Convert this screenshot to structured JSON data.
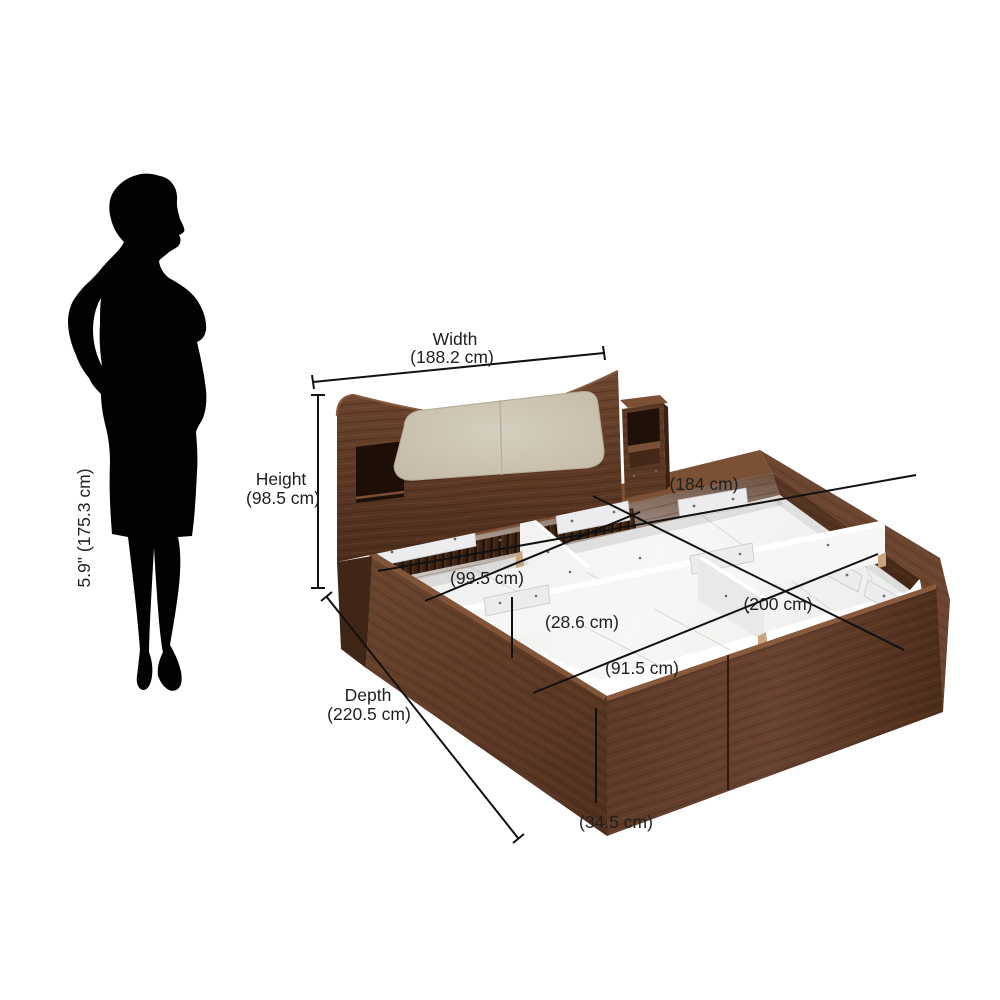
{
  "figure": {
    "type": "storage-bed-dimension-diagram",
    "person_height_label": "5.9\" (175.3 cm)"
  },
  "labels": {
    "width_name": "Width",
    "width_value": "(188.2 cm)",
    "height_name": "Height",
    "height_value": "(98.5 cm)",
    "depth_name": "Depth",
    "depth_value": "(220.5 cm)",
    "inner_width": "(184 cm)",
    "inner_depth": "(200 cm)",
    "storage_width": "(99.5 cm)",
    "storage_height": "(28.6 cm)",
    "storage_depth": "(91.5 cm)",
    "base_height": "(34.5 cm)"
  },
  "colors": {
    "wood_dark": "#452817",
    "wood_mid": "#5e3a26",
    "wood_light": "#7c5035",
    "upholstery": "#cdc4b2",
    "interior_white": "#f4f4f3",
    "silhouette": "#020202",
    "dimension_line": "#111111",
    "text": "#1f1f1f",
    "background": "#ffffff"
  }
}
